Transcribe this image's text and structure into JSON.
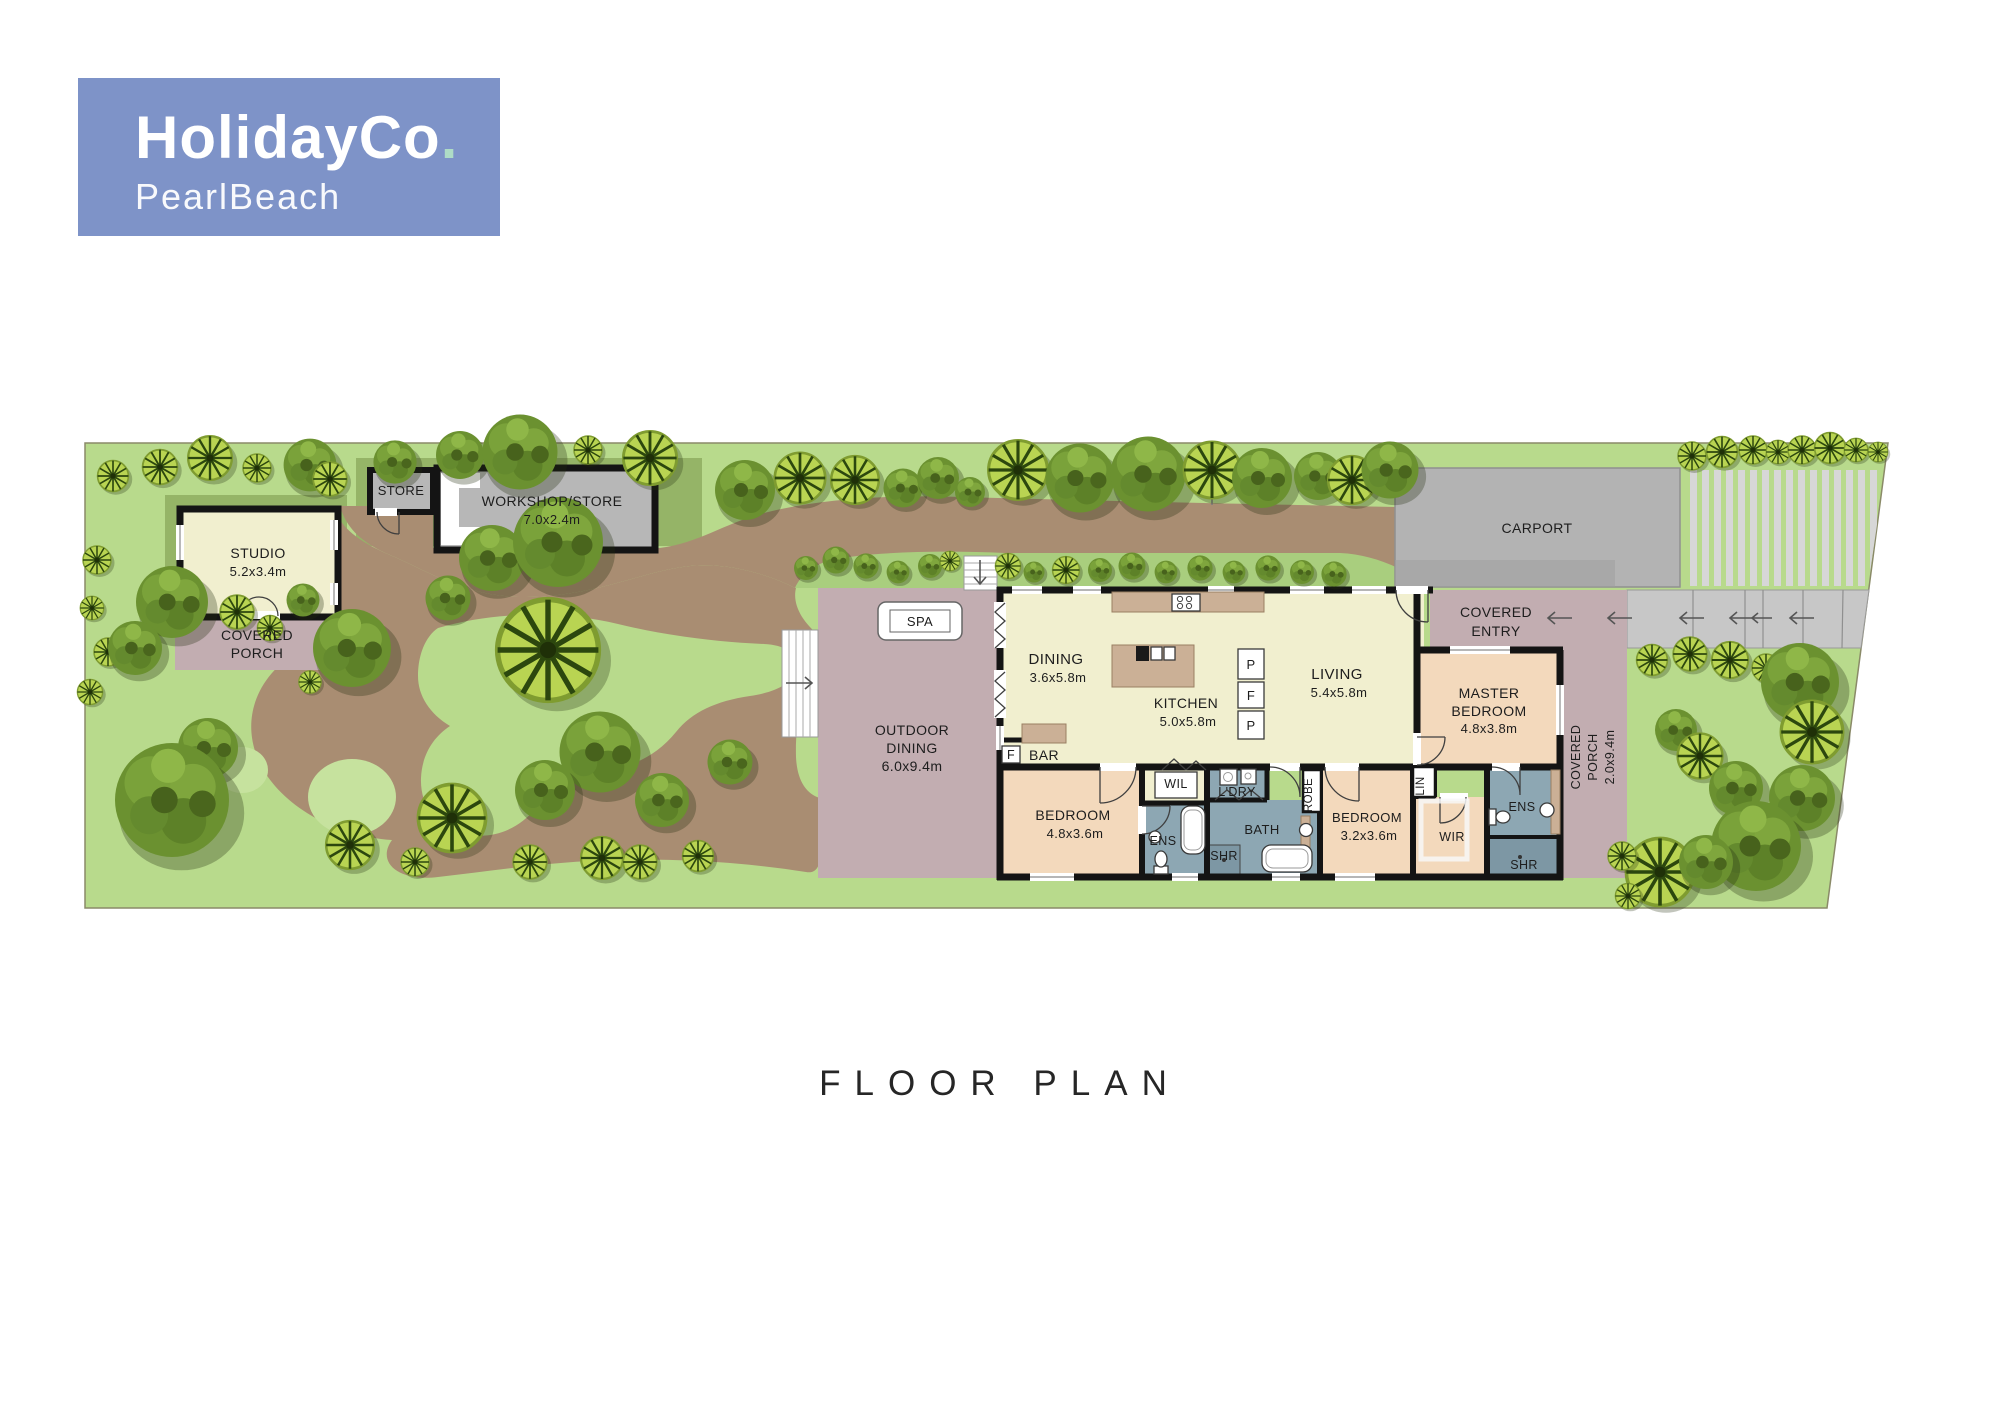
{
  "logo": {
    "brand": "HolidayCo",
    "dot": ".",
    "location": "PearlBeach"
  },
  "page_title": "FLOOR PLAN",
  "colors": {
    "logo_bg": "#7e93c8",
    "logo_dot": "#aedcc6",
    "lawn": "#b8da8c",
    "lawn_dark": "#95b467",
    "island": "#c6e29e",
    "hedge": "#a9ce7e",
    "drive": "#a98d72",
    "mauve": "#c2adb1",
    "cream": "#f1efcf",
    "peach": "#f3d9bc",
    "slate": "#8da7b3",
    "slate_dark": "#7d97a4",
    "bldg_gray": "#b7b7b7",
    "carport": "#b3b3b3",
    "walkway": "#c7c7c7",
    "strip": "#d7d7d7",
    "bench": "#cbb096",
    "wall": "#141414",
    "text": "#1d1d1d",
    "title": "#262626"
  },
  "labels": {
    "store": "STORE",
    "workshop": "WORKSHOP/STORE",
    "workshop_size": "7.0x2.4m",
    "studio": "STUDIO",
    "studio_size": "5.2x3.4m",
    "studio_porch_l1": "COVERED",
    "studio_porch_l2": "PORCH",
    "spa": "SPA",
    "outdoor_l1": "OUTDOOR",
    "outdoor_l2": "DINING",
    "outdoor_size": "6.0x9.4m",
    "dining": "DINING",
    "dining_size": "3.6x5.8m",
    "kitchen": "KITCHEN",
    "kitchen_size": "5.0x5.8m",
    "living": "LIVING",
    "living_size": "5.4x5.8m",
    "bar": "BAR",
    "fridge": "F",
    "pantry_top": "P",
    "fridge_mid": "F",
    "pantry_bottom": "P",
    "entry_l1": "COVERED",
    "entry_l2": "ENTRY",
    "master_l1": "MASTER",
    "master_l2": "BEDROOM",
    "master_size": "4.8x3.8m",
    "bed1": "BEDROOM",
    "bed1_size": "4.8x3.6m",
    "wil": "WIL",
    "ens1": "ENS",
    "ldry": "L'DRY",
    "shr1": "SHR",
    "bath": "BATH",
    "robe": "ROBE",
    "bed2": "BEDROOM",
    "bed2_size": "3.2x3.6m",
    "lin": "LIN",
    "wir": "WIR",
    "ens2": "ENS",
    "shr2": "SHR",
    "porch_l1": "COVERED",
    "porch_l2": "PORCH",
    "porch_size": "2.0x9.4m",
    "carport": "CARPORT"
  }
}
